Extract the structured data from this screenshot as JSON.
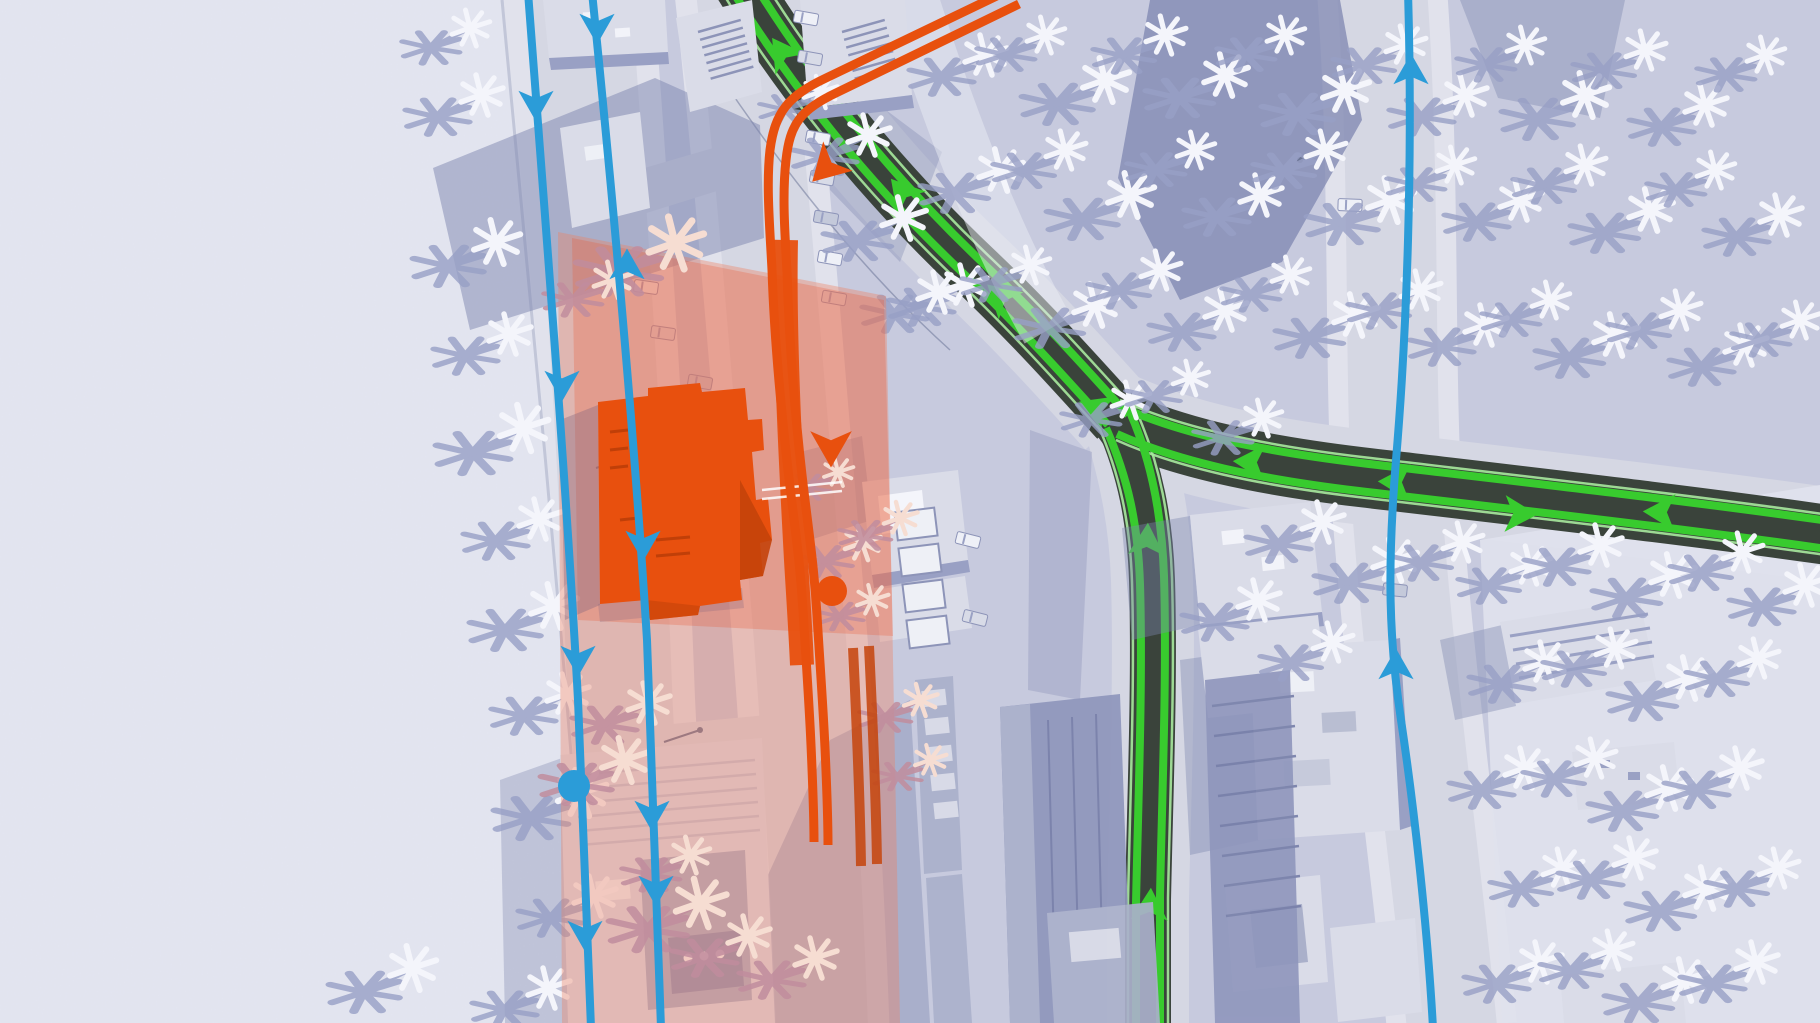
{
  "meta": {
    "screen_type": "game-map-overlay",
    "description": "Top-down city-builder route inspection view: desaturated coastal city with highlighted transport routes, a selected building glowing orange and a translucent highlighted block around it"
  },
  "colors": {
    "ground": "#c7cade",
    "sand": "#e3e5f0",
    "sand_shadow": "#98a0c6",
    "road": "#d5d7e3",
    "sidewalk": "#e1e2ec",
    "road_edge": "#c2c6d8",
    "shadow": "#7e86b0",
    "tree_canopy": "#f4f5fb",
    "building_top": "#dadce8",
    "building_side": "#99a0c4",
    "building_dark": "#7b84ad",
    "asphalt_dark": "#3a433b",
    "road_green": "#38cb2e",
    "road_green_light": "#a9ea9f",
    "transit_blue": "#2b9cd8",
    "route_orange": "#e8500e",
    "route_orange_dark": "#c4430a",
    "selection_salmon": "#ef8160",
    "selection_red": "#e85a35",
    "overpass": "#eaebf3",
    "hill": "#e0e2ed",
    "zone_tree": "#f6ddd2",
    "zone_tree_shadow": "#c18d9e",
    "tower_dark": "#8f96bc",
    "tower_mid": "#aab0cb"
  },
  "overlay": {
    "selection_zone": {
      "label": "highlighted block around selected building"
    },
    "selected_building": {
      "label": "selected building footprint",
      "color_ref": "route_orange"
    },
    "orange_route": {
      "label": "selected route path",
      "stops": 1,
      "arrow_directions": [
        "southwest",
        "south"
      ]
    },
    "blue_lines": [
      {
        "id": "west-line-a",
        "arrows": "southbound",
        "stops": 1
      },
      {
        "id": "west-line-b",
        "arrows": "mixed",
        "stops": 0
      },
      {
        "id": "east-line",
        "arrows": "northbound",
        "stops": 0
      }
    ],
    "green_road": {
      "label": "highlighted road traffic",
      "branches": [
        "northwest",
        "east",
        "south"
      ],
      "lane_lines": 2
    }
  },
  "terrain": {
    "west": "beach",
    "vegetation": "palm trees",
    "east": "hillside with palms"
  }
}
